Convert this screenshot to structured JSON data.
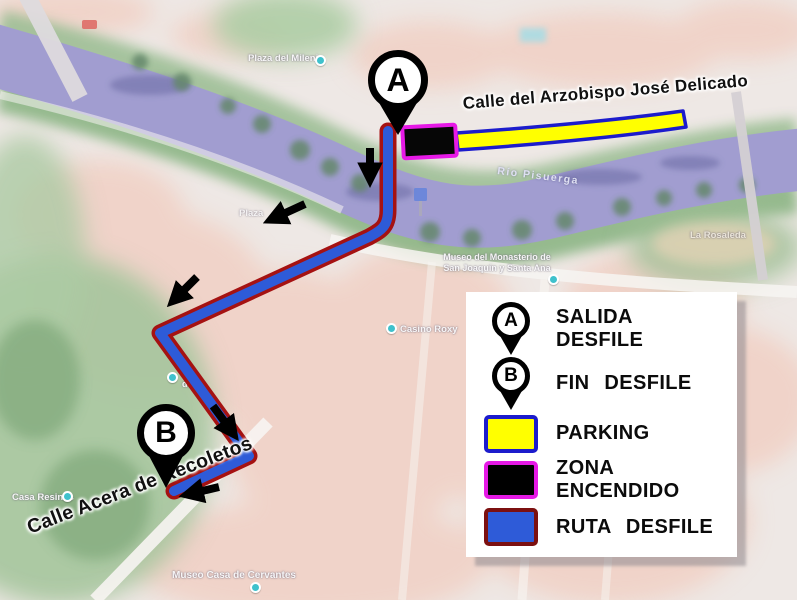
{
  "title": "Parade route map (Valladolid)",
  "legend": {
    "items": [
      {
        "marker": "A",
        "label": "SALIDA DESFILE"
      },
      {
        "marker": "B",
        "label": "FIN DESFILE"
      },
      {
        "label": "PARKING",
        "swatch_fill": "#ffff00",
        "swatch_border": "#1c1ccc"
      },
      {
        "label": "ZONA ENCENDIDO",
        "swatch_fill": "#000000",
        "swatch_border": "#e619e6"
      },
      {
        "label": "RUTA DESFILE",
        "swatch_fill": "#2e5bd8",
        "swatch_border": "#7c1010"
      }
    ]
  },
  "markers": {
    "a": "A",
    "b": "B"
  },
  "street_labels": {
    "arzobispo": "Calle del Arzobispo José Delicado",
    "recoletos": "Calle Acera de Recoletos"
  },
  "map_labels": {
    "rio_pisuerga": "Río Pisuerga",
    "plaza_milenio": "Plaza del Milenio",
    "museo_monasterio_line1": "Museo del Monasterio de",
    "museo_monasterio_line2": "San Joaquín y Santa Ana",
    "casino_roxy": "Casino Roxy",
    "escuela_line1": "Es",
    "escuela_line2": "de Va",
    "plaza_fragment": "Plaza",
    "casa_resines": "Casa Resines",
    "museo_cervantes": "Museo Casa de Cervantes",
    "la_rosaleda": "La Rosaleda"
  },
  "colors": {
    "route_fill": "#2e5bd8",
    "route_border": "#a51212",
    "parking_fill": "#ffff00",
    "parking_border": "#1c1ccc",
    "zona_fill": "#000000",
    "zona_border": "#e619e6",
    "marker": "#000000",
    "river": "#8f8bc7",
    "legend_bg": "#ffffff"
  }
}
